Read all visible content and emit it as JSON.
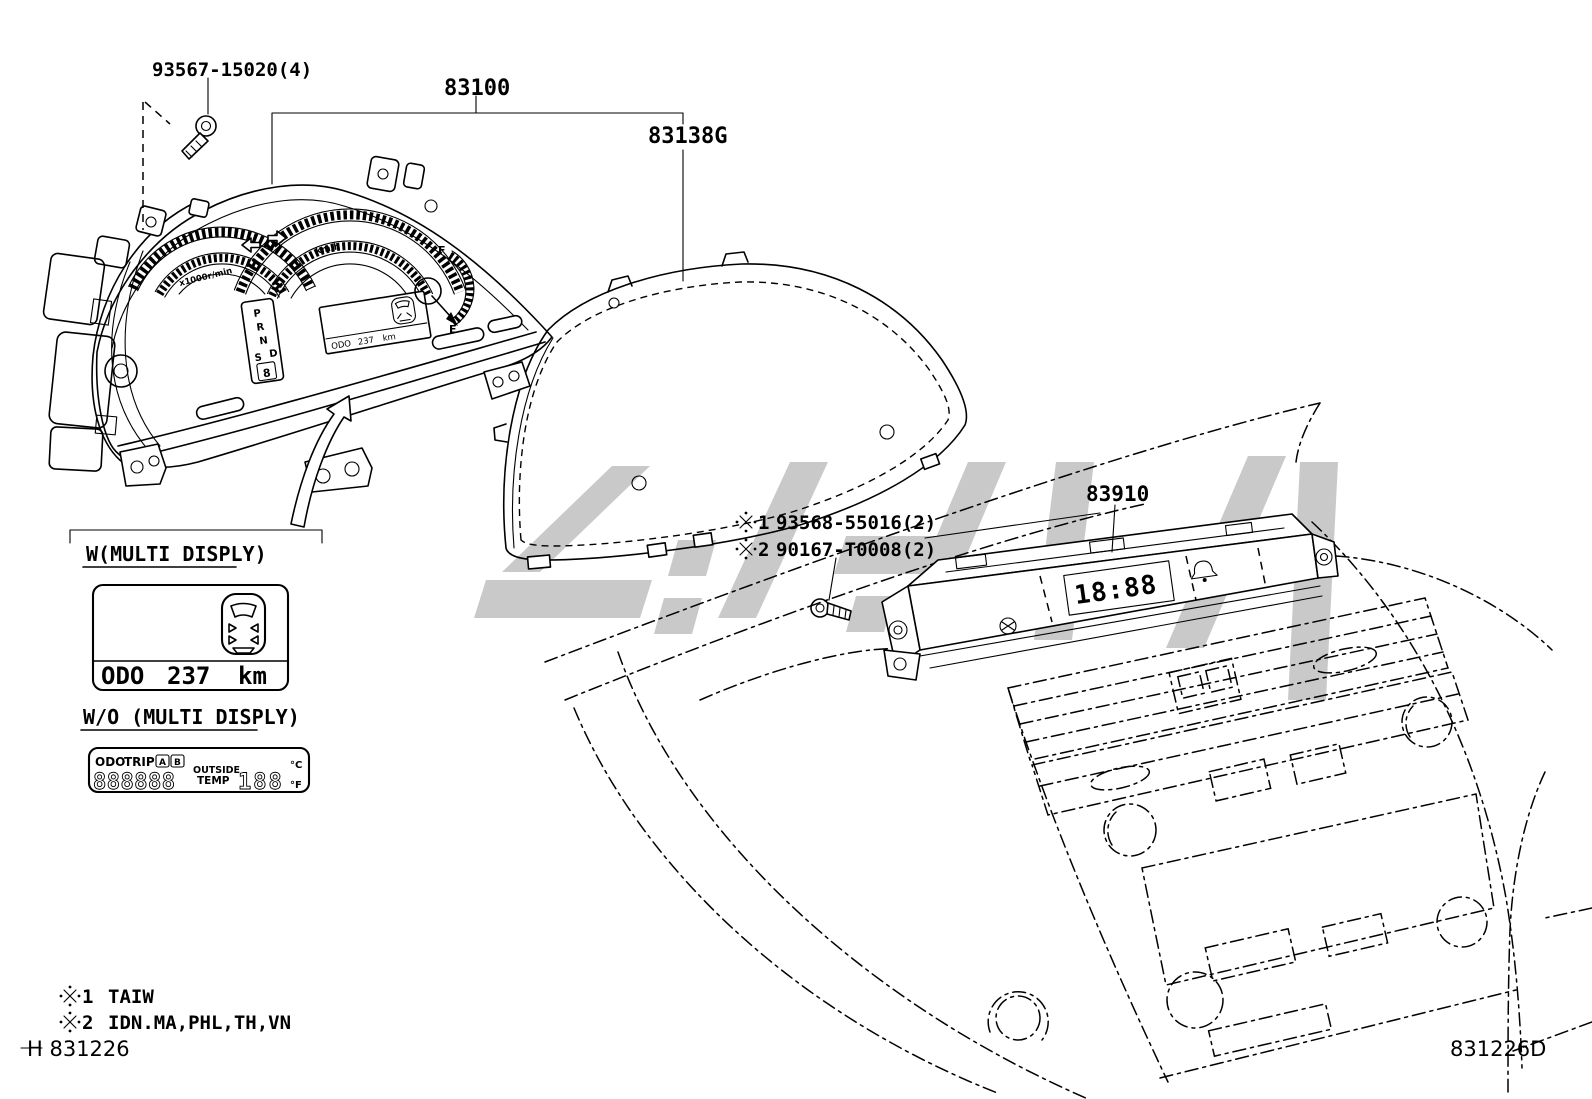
{
  "diagram": {
    "footer_left": "H 831226",
    "footer_right": "831226D"
  },
  "part_labels": {
    "screw": "93567-15020(4)",
    "cluster": "83100",
    "glass": "83138G",
    "clock": "83910"
  },
  "ref_parts": {
    "note1": {
      "label": "※1 93568-55016(2)",
      "num": "1",
      "part": "93568-55016(2)"
    },
    "note2": {
      "label": "※2 90167-T0008(2)",
      "num": "2",
      "part": "90167-T0008(2)"
    }
  },
  "applicability": {
    "note1": {
      "label": "※1 TAIW",
      "num": "1",
      "regions": "TAIW"
    },
    "note2": {
      "label": "※2 IDN.MA,PHL,TH,VN",
      "num": "2",
      "regions": "IDN.MA,PHL,TH,VN"
    }
  },
  "with_multi_display": {
    "title": "W(MULTI DISPLY)",
    "odo_label": "ODO",
    "odo_value": "237",
    "odo_unit": "km"
  },
  "without_multi_display": {
    "title": "W/O (MULTI DISPLY)",
    "lcd": {
      "odo": "ODO",
      "trip": "TRIP",
      "trip_a": "A",
      "trip_b": "B",
      "digits": "888888",
      "outside": "OUTSIDE",
      "temp": "TEMP",
      "temp_value": "188",
      "unit_c": "°C",
      "unit_f": "°F"
    }
  },
  "cluster_face": {
    "tacho_scale": "x1000r/min",
    "speed_unit": "km/h",
    "gears": {
      "p": "P",
      "r": "R",
      "n": "N",
      "d": "D",
      "s": "S",
      "digit": "8"
    },
    "fuel_full": "F",
    "fuel_empty": "E",
    "display_odo": "ODO",
    "display_value": "237",
    "display_unit": "km"
  },
  "clock_unit": {
    "display": "18:88"
  },
  "colors": {
    "line": "#000000",
    "watermark": "#c9c9c9",
    "background": "#ffffff"
  }
}
